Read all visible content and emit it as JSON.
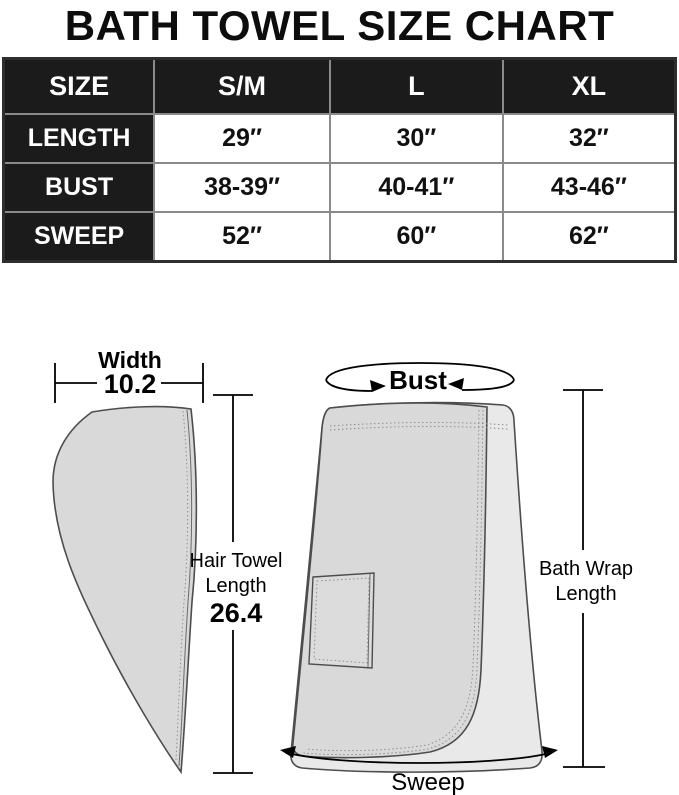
{
  "title": "BATH TOWEL SIZE CHART",
  "size_table": {
    "columns": [
      "SIZE",
      "S/M",
      "L",
      "XL"
    ],
    "rows": [
      {
        "label": "LENGTH",
        "values": [
          "29″",
          "30″",
          "32″"
        ]
      },
      {
        "label": "BUST",
        "values": [
          "38-39″",
          "40-41″",
          "43-46″"
        ]
      },
      {
        "label": "SWEEP",
        "values": [
          "52″",
          "60″",
          "62″"
        ]
      }
    ]
  },
  "diagram": {
    "hair_towel": {
      "width_label": "Width",
      "width_value": "10.2",
      "length_line1": "Hair Towel",
      "length_line2": "Length",
      "length_value": "26.4"
    },
    "bath_wrap": {
      "bust_label": "Bust",
      "length_line1": "Bath Wrap",
      "length_line2": "Length",
      "sweep_label": "Sweep"
    }
  },
  "colors": {
    "table_header_bg": "#1b1b1b",
    "table_header_text": "#ffffff",
    "table_cell_border": "#8a8a8a",
    "table_outer_border": "#2e2e2e",
    "towel_front_fill": "#d9d9d9",
    "towel_back_fill": "#e9e9e9",
    "towel_outline": "#4d4d4d",
    "stitch": "#909090",
    "annotation": "#000000"
  }
}
